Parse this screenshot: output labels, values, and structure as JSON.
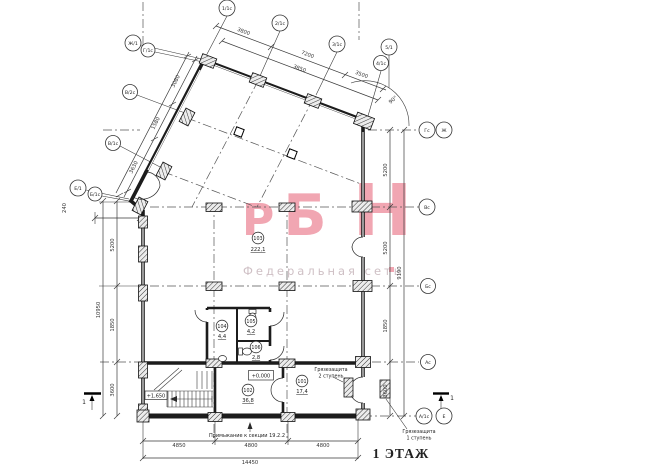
{
  "title": "1 ЭТАЖ",
  "watermark": {
    "letters": [
      "Р",
      "Б",
      "Н"
    ],
    "subtitle": "Федеральная сеть",
    "brand_color": "#f1a6b2"
  },
  "axes": {
    "top": [
      "1/1с",
      "2/1с",
      "3/1с",
      "5/1",
      "4/1с"
    ],
    "left": [
      "Ж/1",
      "Г/1с",
      "В/2с",
      "В/1с",
      "Е/1",
      "Б/1с"
    ],
    "right": [
      "Гс",
      "Ж",
      "Вс",
      "Бс",
      "Ас",
      "А/1с",
      "Е"
    ]
  },
  "dimensions": {
    "top": [
      "3800",
      "7200",
      "3850",
      "3500"
    ],
    "left_oblique": [
      "3080",
      "1580",
      "3630",
      "240"
    ],
    "right_chain": [
      "5200",
      "5200",
      "1850",
      "3600"
    ],
    "right_total": "9190",
    "left_chain": [
      "5200",
      "1850",
      "3600"
    ],
    "left_total": "10950",
    "bottom": [
      "4850",
      "4800",
      "4800"
    ],
    "bottom_total": "14450",
    "angle": "90°"
  },
  "rooms": [
    {
      "number": "101",
      "area": "17,4"
    },
    {
      "number": "102",
      "area": "36,8"
    },
    {
      "number": "103",
      "area": "222,1"
    },
    {
      "number": "104",
      "area": "4,4"
    },
    {
      "number": "105",
      "area": "4,2"
    },
    {
      "number": "106",
      "area": "2,8"
    }
  ],
  "levels": {
    "ground": "+0,000",
    "stair": "+1,650"
  },
  "notes": {
    "adjoining": "Примыкание к секции 19.2.2",
    "mud_guard_2": "Грязезащита",
    "mud_guard_2_sub": "2 ступень",
    "mud_guard_1": "Грязезащита",
    "mud_guard_1_sub": "1 ступень",
    "section_mark": "1"
  }
}
